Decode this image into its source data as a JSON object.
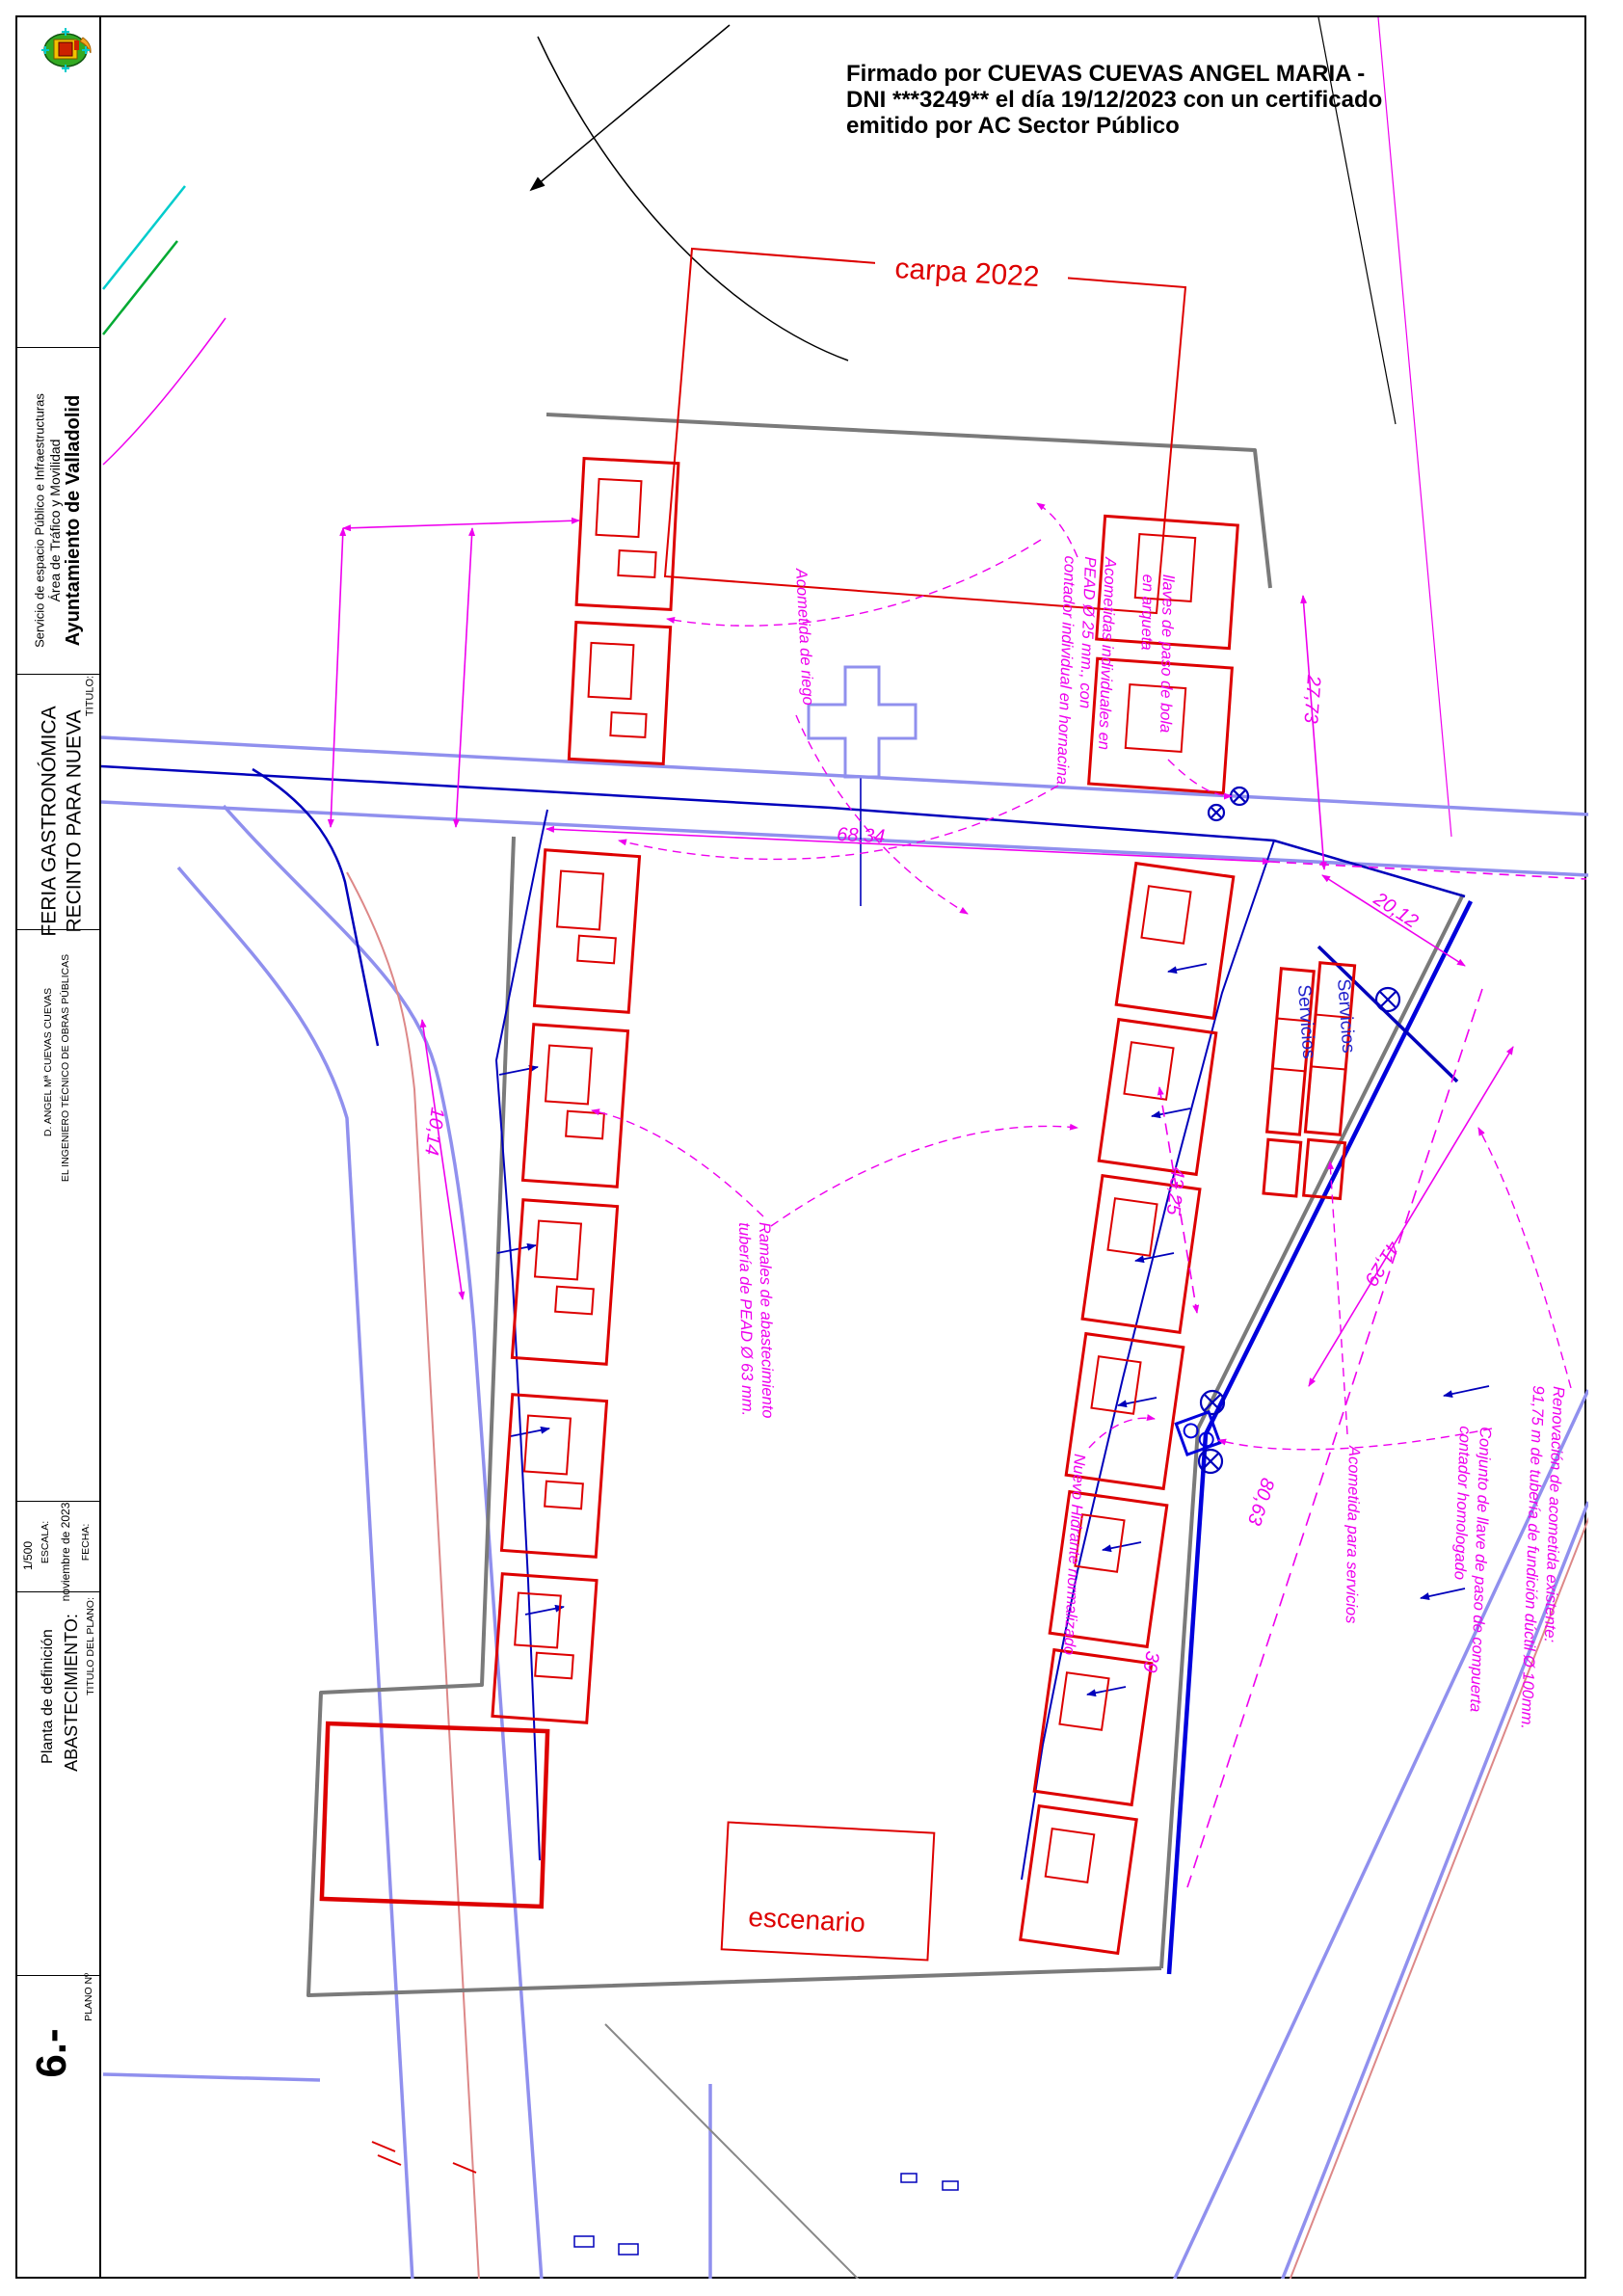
{
  "titleblock": {
    "org_name": "Ayuntamiento de Valladolid",
    "org_area": "Área de Tráfico y Movilidad",
    "org_service": "Servicio de espacio Público e Infraestructuras",
    "titulo_label": "TITULO:",
    "titulo_line1": "RECINTO PARA NUEVA",
    "titulo_line2": "FERIA GASTRONÓMICA",
    "engineer_title": "EL INGENIERO TÉCNICO DE OBRAS PÚBLICAS",
    "engineer_name": "D. ANGEL Mª CUEVAS CUEVAS",
    "fecha_label": "FECHA:",
    "fecha_value": "noviembre de 2023",
    "escala_label": "ESCALA:",
    "escala_value": "1/500",
    "plano_titulo_label": "TITULO DEL PLANO:",
    "plano_titulo_line1": "ABASTECIMIENTO:",
    "plano_titulo_line2": "Planta de definición",
    "plano_num_label": "PLANO Nº",
    "plano_num": "6.-"
  },
  "signature": {
    "line1": "Firmado por CUEVAS CUEVAS ANGEL MARIA -",
    "line2": "DNI ***3249** el día 19/12/2023 con un certificado",
    "line3": "emitido por AC Sector Público"
  },
  "plan_labels": {
    "carpa": "carpa 2022",
    "escenario": "escenario",
    "servicios": "Servicios"
  },
  "dimensions": {
    "d6834": "68,34",
    "d2773": "27,73",
    "d2012": "20,12",
    "d1014": "10,14",
    "d4325": "43,25",
    "d4129": "41,29",
    "d8063": "80,63",
    "d39": "39"
  },
  "annotations": {
    "riego": "Acometida de riego",
    "acometidas_1": "Acometidas individuales en",
    "acometidas_2": "PEAD Ø 25 mm., con",
    "acometidas_3": "contador individual en hornacina",
    "llaves_1": "llaves de paso de bola",
    "llaves_2": "en arqueta",
    "ramales_1": "Ramales de abastecimiento",
    "ramales_2": "tubería de PEAD Ø 63 mm.",
    "hidrante": "Nuevo Hidrante normalizado",
    "acometida_servicios": "Acometida para servicios",
    "conjunto_1": "Conjunto de llave de paso de compuerta",
    "conjunto_2": "contador homologado",
    "renovacion_1": "Renovación de acometida existente:",
    "renovacion_2": "91,75 m de tubería de fundición dúctil Ø 100mm."
  },
  "colors": {
    "red": "#dd0000",
    "magenta": "#ee00ee",
    "pipe_blue": "#0000bb",
    "street": "#9090ee",
    "boundary_gray": "#7a7a7a",
    "black": "#000000"
  }
}
